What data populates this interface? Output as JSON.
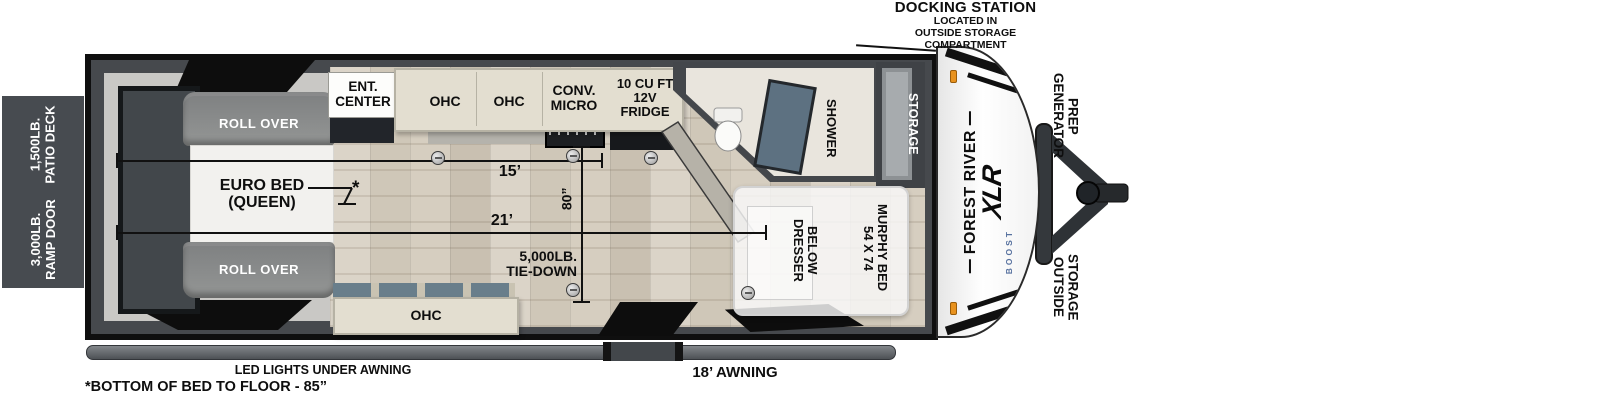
{
  "annotations": {
    "docking_station_title": "DOCKING STATION",
    "docking_station_note": "LOCATED IN\nOUTSIDE STORAGE\nCOMPARTMENT",
    "led_lights": "LED LIGHTS UNDER AWNING",
    "awning": "18’ AWNING",
    "bed_note": "*BOTTOM OF BED TO FLOOR - 85”",
    "bed_note_marker": "*"
  },
  "exterior": {
    "patio_deck": "1,500LB.\nPATIO DECK",
    "ramp_door": "3,000LB.\nRAMP DOOR",
    "generator_prep": "GENERATOR\nPREP",
    "outside_storage": "OUTSIDE\nSTORAGE",
    "brand": {
      "name": "FOREST RIVER",
      "model": "XLR",
      "submodel": "BOOST"
    }
  },
  "bedroom": {
    "roll_over_top": "ROLL OVER",
    "roll_over_bottom": "ROLL OVER",
    "euro_bed": "EURO  BED\n(QUEEN)"
  },
  "kitchen": {
    "ent_center": "ENT.\nCENTER",
    "ohc_left": "OHC",
    "ohc_right": "OHC",
    "conv_micro": "CONV.\nMICRO",
    "fridge": "10 CU FT\n12V\nFRIDGE",
    "ohc_bottom": "OHC"
  },
  "bathroom": {
    "shower": "SHOWER"
  },
  "front_storage": {
    "label": "STORAGE"
  },
  "murphy": {
    "bed": "54 X 74\nMURPHY BED",
    "dresser": "DRESSER\nBELOW"
  },
  "dimensions": {
    "main_length": "15’",
    "full_length": "21’",
    "interior_width": "80”",
    "tie_down": "5,000LB.\nTIE-DOWN"
  },
  "colors": {
    "wall_dark": "#46494d",
    "annexe_gray": "#474b50",
    "wood_tone": "#d6cec0",
    "shower_glass": "#5d7181",
    "boost_blue": "#57719f",
    "marker_light_orange": "#e8921e"
  }
}
